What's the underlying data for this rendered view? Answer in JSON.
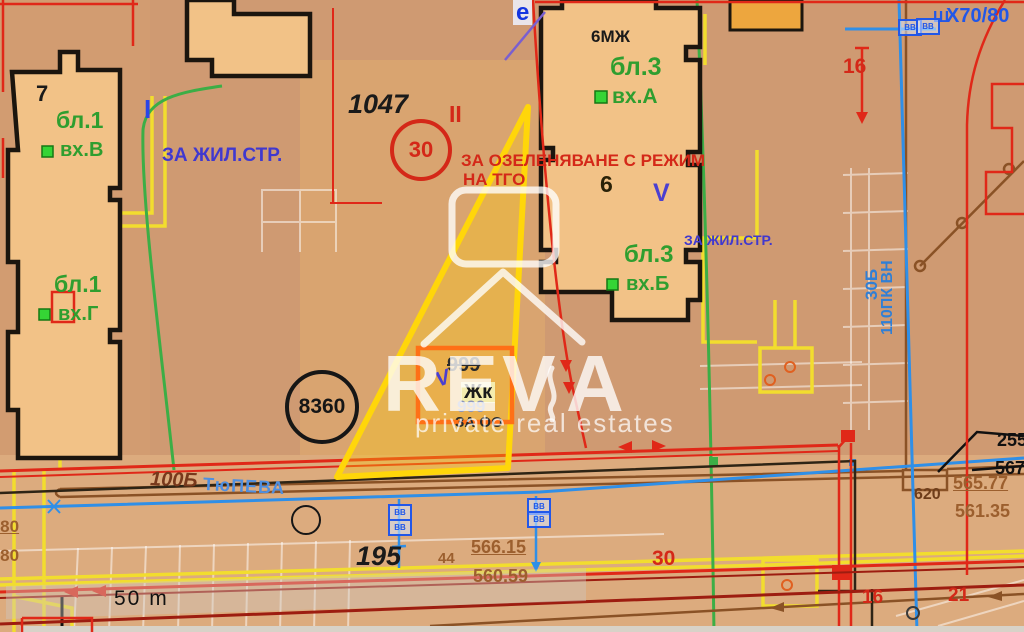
{
  "map": {
    "title": "cadastral-regulation-plan",
    "palette": {
      "base": "#d29c71",
      "building": "#f2c287",
      "street": "#dcab7e",
      "zone_dark": "#cf9a72",
      "parcel_light": "#d9a470",
      "outline": "#1b150e",
      "red": "#e02818",
      "dark_red": "#9d1d10",
      "yellow": "#f2dd2e",
      "highlight": "#ffd60a",
      "orange": "#ff7016",
      "green": "#3cae46",
      "green_label": "#2f9e2f",
      "blue": "#2f8fe8",
      "blue_label": "#4038cf",
      "brown": "#8a5226",
      "brown_label": "#9c5f2e",
      "ghost": "rgba(255,255,255,0.5)",
      "watermark": "rgba(255,255,255,0.78)"
    },
    "labels": [
      {
        "name": "parcel-7",
        "text": "7",
        "x": 36,
        "y": 82,
        "size": 22,
        "color": "#1a1a1a"
      },
      {
        "name": "block-1-label-v",
        "text": "бл.1",
        "x": 56,
        "y": 108,
        "size": 23,
        "color": "#2f9e2f"
      },
      {
        "name": "entrance-v-label",
        "text": "вх.В",
        "x": 60,
        "y": 140,
        "size": 20,
        "color": "#2f9e2f"
      },
      {
        "name": "block-1-label-g",
        "text": "бл.1",
        "x": 54,
        "y": 272,
        "size": 23,
        "color": "#2f9e2f"
      },
      {
        "name": "entrance-g-label",
        "text": "вх.Г",
        "x": 58,
        "y": 304,
        "size": 20,
        "color": "#2f9e2f"
      },
      {
        "name": "roman-i-label",
        "text": "I",
        "x": 144,
        "y": 96,
        "size": 26,
        "color": "#2b46e8"
      },
      {
        "name": "zone-zhil-str-left",
        "text": "ЗА ЖИЛ.СТР.",
        "x": 162,
        "y": 146,
        "size": 19,
        "color": "#4038cf"
      },
      {
        "name": "parcel-1047",
        "text": "1047",
        "x": 348,
        "y": 90,
        "size": 27,
        "color": "#1a1a1a",
        "style": "italic"
      },
      {
        "name": "roman-ii-label",
        "text": "II",
        "x": 449,
        "y": 102,
        "size": 23,
        "color": "#d42818"
      },
      {
        "name": "zone-ozelenyavane-line1",
        "text": "ЗА ОЗЕЛЕНЯВАНЕ С РЕЖИМ",
        "x": 461,
        "y": 152,
        "size": 17,
        "color": "#d42818"
      },
      {
        "name": "zone-ozelenyavane-line2",
        "text": "НА ТГО",
        "x": 463,
        "y": 171,
        "size": 17,
        "color": "#d42818"
      },
      {
        "name": "marker-e",
        "text": "e",
        "x": 513,
        "y": 0,
        "size": 24,
        "color": "#1535e0",
        "bg": "rgba(238,242,255,0.85)"
      },
      {
        "name": "building-6mzh",
        "text": "6МЖ",
        "x": 591,
        "y": 28,
        "size": 17,
        "color": "#1a1a1a"
      },
      {
        "name": "block-3-label-a",
        "text": "бл.3",
        "x": 610,
        "y": 54,
        "size": 25,
        "color": "#2f9e2f"
      },
      {
        "name": "entrance-a-label",
        "text": "вх.А",
        "x": 612,
        "y": 86,
        "size": 21,
        "color": "#2f9e2f"
      },
      {
        "name": "parcel-6",
        "text": "6",
        "x": 600,
        "y": 172,
        "size": 23,
        "color": "#2a2208"
      },
      {
        "name": "roman-v-label",
        "text": "V",
        "x": 653,
        "y": 180,
        "size": 25,
        "color": "#4b3fd0"
      },
      {
        "name": "block-3-label-b",
        "text": "бл.3",
        "x": 624,
        "y": 242,
        "size": 24,
        "color": "#2f9e2f"
      },
      {
        "name": "entrance-b-label",
        "text": "вх.Б",
        "x": 626,
        "y": 274,
        "size": 20,
        "color": "#2f9e2f"
      },
      {
        "name": "zone-zhil-str-right",
        "text": "ЗА ЖИЛ.СТР.",
        "x": 684,
        "y": 233,
        "size": 14,
        "color": "#4038cf"
      },
      {
        "name": "line-x70-80",
        "text": "X70/80",
        "x": 946,
        "y": 6,
        "size": 20,
        "color": "#2257e8"
      },
      {
        "name": "glyph-sh",
        "text": "Ш",
        "x": 933,
        "y": 10,
        "size": 16,
        "color": "#2257e8"
      },
      {
        "name": "parcel-16-top",
        "text": "16",
        "x": 843,
        "y": 56,
        "size": 21,
        "color": "#d42818"
      },
      {
        "name": "crossed-999",
        "text": "999",
        "x": 447,
        "y": 355,
        "size": 20,
        "color": "#2a2a2a",
        "strike": true
      },
      {
        "name": "roman-v-small",
        "text": "V",
        "x": 436,
        "y": 368,
        "size": 21,
        "color": "#4b3fd0",
        "style": "italic",
        "rotate": -20
      },
      {
        "name": "zhk-label",
        "text": "Жк",
        "x": 461,
        "y": 382,
        "size": 20,
        "color": "#1a1a1a",
        "bg": "#f4ecae"
      },
      {
        "name": "faded-999",
        "text": "999",
        "x": 457,
        "y": 398,
        "size": 17,
        "color": "#8d96bb"
      },
      {
        "name": "za-oo-label",
        "text": "ЗА ОО",
        "x": 455,
        "y": 415,
        "size": 15,
        "color": "#2a2a2a"
      },
      {
        "name": "street-number-100b",
        "text": "100Б",
        "x": 150,
        "y": 470,
        "size": 20,
        "color": "#78391c",
        "style": "italic",
        "rotate": 2
      },
      {
        "name": "street-name",
        "text": "ТюПЕВА",
        "x": 203,
        "y": 477,
        "size": 18,
        "color": "#4f8fe0",
        "rotate": 3,
        "spacing": 1
      },
      {
        "name": "parcel-195",
        "text": "195",
        "x": 356,
        "y": 542,
        "size": 27,
        "color": "#1a1a1a",
        "style": "italic"
      },
      {
        "name": "parcel-44",
        "text": "44",
        "x": 438,
        "y": 551,
        "size": 15,
        "color": "#9c5f2e"
      },
      {
        "name": "elev-566-15",
        "text": "566.15",
        "x": 471,
        "y": 538,
        "size": 18,
        "color": "#9c5f2e",
        "underline": true
      },
      {
        "name": "elev-560-59",
        "text": "560.59",
        "x": 473,
        "y": 567,
        "size": 18,
        "color": "#9c5f2e"
      },
      {
        "name": "elev-565-77",
        "text": "565.77",
        "x": 953,
        "y": 474,
        "size": 18,
        "color": "#9c5f2e",
        "underline": true
      },
      {
        "name": "elev-561-35",
        "text": "561.35",
        "x": 955,
        "y": 502,
        "size": 18,
        "color": "#9c5f2e"
      },
      {
        "name": "node-620",
        "text": "620",
        "x": 914,
        "y": 487,
        "size": 16,
        "color": "#6e3d1a"
      },
      {
        "name": "parcel-255",
        "text": "255",
        "x": 997,
        "y": 431,
        "size": 18,
        "color": "#111111"
      },
      {
        "name": "parcel-567",
        "text": "567",
        "x": 995,
        "y": 459,
        "size": 18,
        "color": "#111111"
      },
      {
        "name": "parcel-30-bottom",
        "text": "30",
        "x": 652,
        "y": 548,
        "size": 21,
        "color": "#d42818"
      },
      {
        "name": "parcel-16-bottom",
        "text": "16",
        "x": 862,
        "y": 588,
        "size": 19,
        "color": "#d42818"
      },
      {
        "name": "parcel-21",
        "text": "21",
        "x": 948,
        "y": 586,
        "size": 19,
        "color": "#d42818"
      },
      {
        "name": "elev-1-80",
        "text": "1.80",
        "x": -14,
        "y": 518,
        "size": 17,
        "color": "#9c5f2e",
        "underline": true
      },
      {
        "name": "elev-0-80",
        "text": "0.80",
        "x": -14,
        "y": 547,
        "size": 17,
        "color": "#9c5f2e"
      },
      {
        "name": "scale-text",
        "text": "50 m",
        "x": 114,
        "y": 588,
        "size": 21,
        "color": "#111111",
        "weight": 400,
        "spacing": 2
      }
    ],
    "vertical_labels": [
      {
        "name": "powerline-110pk-vn",
        "text": "110ПК ВН",
        "x": 880,
        "y": 335,
        "size": 16
      },
      {
        "name": "powerline-30b",
        "text": "30Б",
        "x": 863,
        "y": 300,
        "size": 17
      }
    ],
    "circles": [
      {
        "name": "circle-30",
        "text": "30",
        "cx": 417,
        "cy": 146,
        "r": 27,
        "border": "#d42818",
        "color": "#d42818",
        "size": 22,
        "bw": 4
      },
      {
        "name": "circle-8360",
        "text": "8360",
        "cx": 318,
        "cy": 403,
        "r": 33,
        "border": "#161616",
        "color": "#161616",
        "size": 21,
        "bw": 4
      },
      {
        "name": "circle-small-street",
        "text": "",
        "cx": 304,
        "cy": 518,
        "r": 13,
        "border": "#161616",
        "color": "#161616",
        "size": 10,
        "bw": 2
      }
    ],
    "vv_boxes": [
      {
        "name": "vv-valve-1",
        "text": "ВВ",
        "x": 388,
        "y": 504
      },
      {
        "name": "vv-valve-2",
        "text": "ВВ",
        "x": 388,
        "y": 519
      },
      {
        "name": "vv-valve-3",
        "text": "ВВ",
        "x": 527,
        "y": 498
      },
      {
        "name": "vv-valve-4",
        "text": "ВВ",
        "x": 527,
        "y": 511
      },
      {
        "name": "vv-valve-5",
        "text": "ВВ",
        "x": 898,
        "y": 19
      },
      {
        "name": "vv-valve-6",
        "text": "ВВ",
        "x": 916,
        "y": 18
      }
    ],
    "watermark": {
      "brand_prefix": "REV",
      "brand_suffix": "A",
      "tagline": "private real estates"
    }
  }
}
